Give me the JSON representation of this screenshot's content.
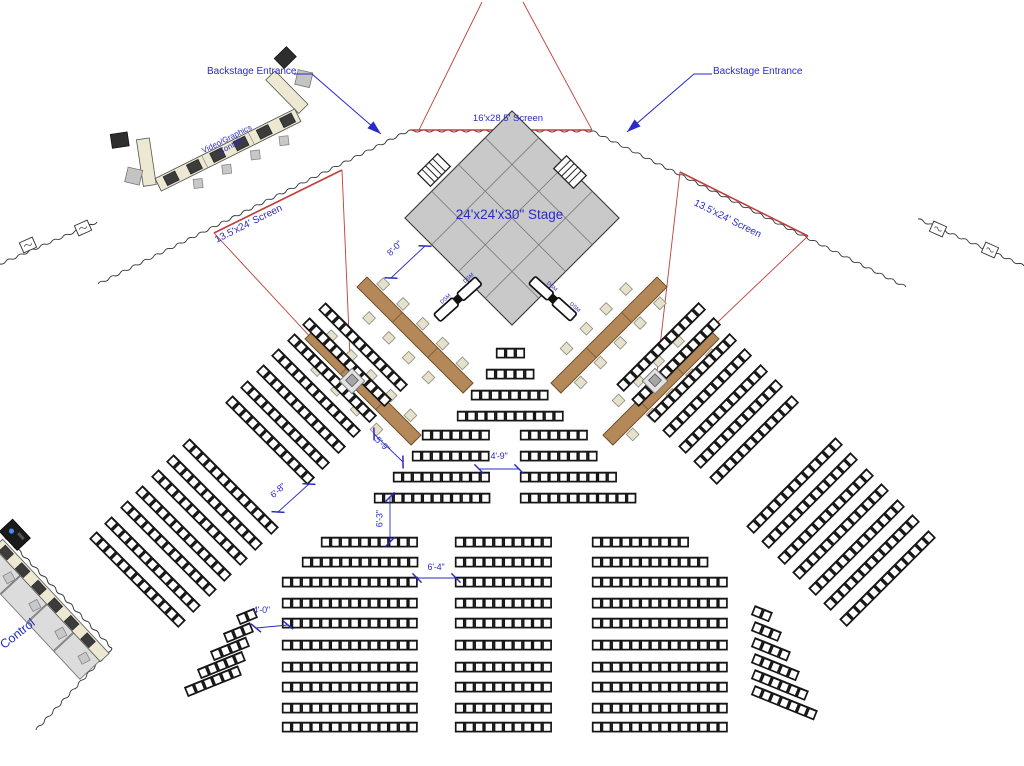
{
  "canvas": {
    "width": 1024,
    "height": 766,
    "background": "#ffffff"
  },
  "colors": {
    "annotation_blue": "#2a2ac8",
    "projection_red": "#bf4038",
    "drape_black": "#333333",
    "seat_stroke": "#151515",
    "stage_fill": "#c9c9c9",
    "stage_grid": "#6e6e6e",
    "head_table_fill": "#b5885a",
    "head_table_edge": "#6b4f28",
    "desk_fill": "#ece8d2",
    "equipment_dark": "#3c3c3c",
    "platform_gray": "#dcdcdc",
    "chair_gray": "#e6e1cc"
  },
  "labels": {
    "backstage_left": "Backstage Entrance",
    "backstage_right": "Backstage Entrance",
    "screen_top": "16'x28.5' Screen",
    "stage": "24'x24'x30\" Stage",
    "screen_left": "13.5'x24' Screen",
    "screen_right": "13.5'x24' Screen",
    "video_control_line1": "Video/Graphics",
    "video_control_line2": "Control",
    "control": "Control",
    "dsm": "DSM"
  },
  "dimensions": [
    {
      "label": "8'-0\"",
      "line": [
        425,
        246,
        391,
        278
      ]
    },
    {
      "label": "5'-9\"",
      "line": [
        374,
        434,
        403,
        462
      ]
    },
    {
      "label": "4'-9\"",
      "line": [
        479,
        469,
        519,
        469
      ]
    },
    {
      "label": "6'-3\"",
      "line": [
        390,
        497,
        390,
        542
      ]
    },
    {
      "label": "6'-4\"",
      "line": [
        417,
        578,
        456,
        578
      ]
    },
    {
      "label": "6'-8\"",
      "line": [
        309,
        484,
        278,
        512
      ]
    },
    {
      "label": "4'-0\"",
      "line": [
        256,
        628,
        288,
        625
      ]
    }
  ],
  "stage": {
    "cx": 512,
    "cy": 218,
    "half_side": 75.7,
    "rotation": 45,
    "grid_divisions": 4
  },
  "stairs": [
    {
      "x": 434,
      "y": 170,
      "angle": -45
    },
    {
      "x": 570,
      "y": 172,
      "angle": 45
    }
  ],
  "drapes": {
    "segments": [
      [
        408,
        131,
        592,
        131
      ],
      [
        408,
        131,
        98,
        284
      ],
      [
        97,
        222,
        0,
        264
      ],
      [
        592,
        131,
        906,
        287
      ],
      [
        918,
        219,
        1024,
        266
      ],
      [
        0,
        531,
        112,
        648
      ],
      [
        112,
        648,
        36,
        730
      ]
    ],
    "boxes": [
      [
        28,
        245,
        -24
      ],
      [
        83,
        228,
        -24
      ],
      [
        938,
        229,
        24
      ],
      [
        990,
        250,
        24
      ]
    ]
  },
  "projection": {
    "screen_lines": [
      [
        410,
        130,
        592,
        130
      ],
      [
        214,
        233,
        342,
        170
      ],
      [
        680,
        172,
        808,
        236
      ]
    ],
    "cone_lines": [
      [
        419,
        130,
        482,
        2
      ],
      [
        592,
        130,
        523,
        2
      ],
      [
        214,
        233,
        351,
        381
      ],
      [
        342,
        170,
        351,
        381
      ],
      [
        680,
        172,
        656,
        381
      ],
      [
        808,
        236,
        656,
        381
      ]
    ]
  },
  "projectors": [
    [
      352,
      381
    ],
    [
      655,
      381
    ]
  ],
  "head_tables": {
    "length": 150,
    "tables": [
      {
        "x": 362,
        "y": 282,
        "angle": 45
      },
      {
        "x": 310,
        "y": 334,
        "angle": 45
      },
      {
        "x": 662,
        "y": 282,
        "angle": 135
      },
      {
        "x": 714,
        "y": 334,
        "angle": 135
      }
    ]
  },
  "dsm_tables": [
    {
      "x": 437,
      "y": 318,
      "angle": -42
    },
    {
      "x": 532,
      "y": 280,
      "angle": 42
    }
  ],
  "video_control": {
    "x": 228,
    "y": 150,
    "angle": -26.5
  },
  "control_station": {
    "x": 2,
    "y": 540,
    "angle": 47
  },
  "arrows": [
    {
      "points": [
        [
          294,
          74
        ],
        [
          312,
          74
        ],
        [
          381,
          134
        ]
      ]
    },
    {
      "points": [
        [
          712,
          74
        ],
        [
          694,
          74
        ],
        [
          627,
          132
        ]
      ]
    }
  ],
  "seating": {
    "seat_pitch": 9.7,
    "sections": [
      {
        "id": "center-front-pyramid",
        "angle": 0,
        "rows": [
          [
            496,
            353,
            3
          ],
          [
            486,
            374,
            5
          ],
          [
            471,
            395,
            8
          ],
          [
            457,
            416,
            11
          ]
        ]
      },
      {
        "id": "center-mid-left",
        "angle": 0,
        "rows": [
          [
            422,
            435,
            7
          ],
          [
            412,
            456,
            8
          ],
          [
            393,
            477,
            10
          ],
          [
            374,
            498,
            12
          ]
        ]
      },
      {
        "id": "center-mid-right",
        "angle": 0,
        "rows": [
          [
            520,
            435,
            7
          ],
          [
            520,
            456,
            8
          ],
          [
            520,
            477,
            10
          ],
          [
            520,
            498,
            12
          ]
        ]
      },
      {
        "id": "rear-left",
        "angle": 0,
        "rows": [
          [
            321,
            542,
            10
          ],
          [
            302,
            562,
            12
          ],
          [
            282,
            582,
            14
          ],
          [
            282,
            603,
            14
          ],
          [
            282,
            623,
            14
          ],
          [
            282,
            645,
            14
          ],
          [
            282,
            667,
            14
          ],
          [
            282,
            687,
            14
          ],
          [
            282,
            708,
            14
          ],
          [
            282,
            727,
            14
          ]
        ]
      },
      {
        "id": "rear-center",
        "angle": 0,
        "rows": [
          [
            455,
            542,
            10
          ],
          [
            455,
            562,
            10
          ],
          [
            455,
            582,
            10
          ],
          [
            455,
            603,
            10
          ],
          [
            455,
            623,
            10
          ],
          [
            455,
            645,
            10
          ],
          [
            455,
            667,
            10
          ],
          [
            455,
            687,
            10
          ],
          [
            455,
            708,
            10
          ],
          [
            455,
            727,
            10
          ]
        ]
      },
      {
        "id": "rear-right",
        "angle": 0,
        "rows": [
          [
            592,
            542,
            10
          ],
          [
            592,
            562,
            12
          ],
          [
            592,
            582,
            14
          ],
          [
            592,
            603,
            14
          ],
          [
            592,
            623,
            14
          ],
          [
            592,
            645,
            14
          ],
          [
            592,
            667,
            14
          ],
          [
            592,
            687,
            14
          ],
          [
            592,
            708,
            14
          ],
          [
            592,
            727,
            14
          ]
        ]
      },
      {
        "id": "left-wing-upper",
        "angle": 45,
        "rows": [
          [
            322,
            306,
            12
          ],
          [
            306,
            321,
            12
          ],
          [
            291,
            337,
            12
          ],
          [
            275,
            352,
            12
          ],
          [
            260,
            368,
            12
          ],
          [
            244,
            384,
            12
          ],
          [
            229,
            399,
            12
          ]
        ]
      },
      {
        "id": "left-wing-lower",
        "angle": 45,
        "rows": [
          [
            186,
            442,
            13
          ],
          [
            170,
            458,
            13
          ],
          [
            155,
            473,
            13
          ],
          [
            139,
            489,
            13
          ],
          [
            124,
            504,
            13
          ],
          [
            108,
            520,
            13
          ],
          [
            93,
            535,
            13
          ]
        ]
      },
      {
        "id": "right-wing-upper",
        "angle": -45,
        "rows": [
          [
            620,
            388,
            12
          ],
          [
            635,
            403,
            12
          ],
          [
            651,
            419,
            12
          ],
          [
            666,
            434,
            12
          ],
          [
            682,
            450,
            12
          ],
          [
            697,
            465,
            12
          ],
          [
            713,
            481,
            12
          ]
        ]
      },
      {
        "id": "right-wing-lower",
        "angle": -45,
        "rows": [
          [
            750,
            530,
            13
          ],
          [
            765,
            545,
            13
          ],
          [
            781,
            561,
            13
          ],
          [
            796,
            576,
            13
          ],
          [
            812,
            592,
            13
          ],
          [
            827,
            607,
            13
          ],
          [
            843,
            623,
            13
          ]
        ]
      },
      {
        "id": "left-rear-wedge",
        "angle": -22,
        "rows": [
          [
            238,
            620,
            2
          ],
          [
            225,
            638,
            3
          ],
          [
            212,
            656,
            4
          ],
          [
            199,
            674,
            5
          ],
          [
            186,
            692,
            6
          ]
        ]
      },
      {
        "id": "right-rear-wedge",
        "angle": 22,
        "rows": [
          [
            753,
            610,
            2
          ],
          [
            753,
            626,
            3
          ],
          [
            753,
            642,
            4
          ],
          [
            753,
            658,
            5
          ],
          [
            753,
            674,
            6
          ],
          [
            753,
            690,
            7
          ]
        ]
      }
    ]
  }
}
